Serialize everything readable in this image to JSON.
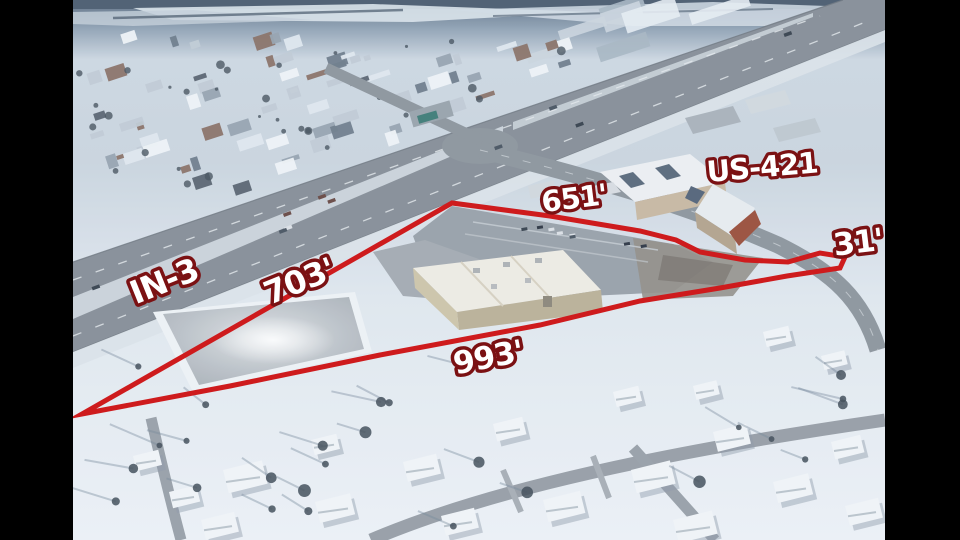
{
  "scene": {
    "type": "aerial-drone-photograph",
    "setting": "snow-covered town at a highway intersection, winter, letterboxed photo"
  },
  "letterbox": {
    "color": "#000000"
  },
  "boundary": {
    "color": "#ce1b1d",
    "shape": "red property-outline polygon with four labeled sides"
  },
  "labels": {
    "road_in3": "IN-3",
    "road_us421": "US-421",
    "dim_north": "651'",
    "dim_west": "703'",
    "dim_east": "31'",
    "dim_south": "993'"
  },
  "label_style": {
    "fill": "#ffffff",
    "outline": "#7b1113"
  }
}
